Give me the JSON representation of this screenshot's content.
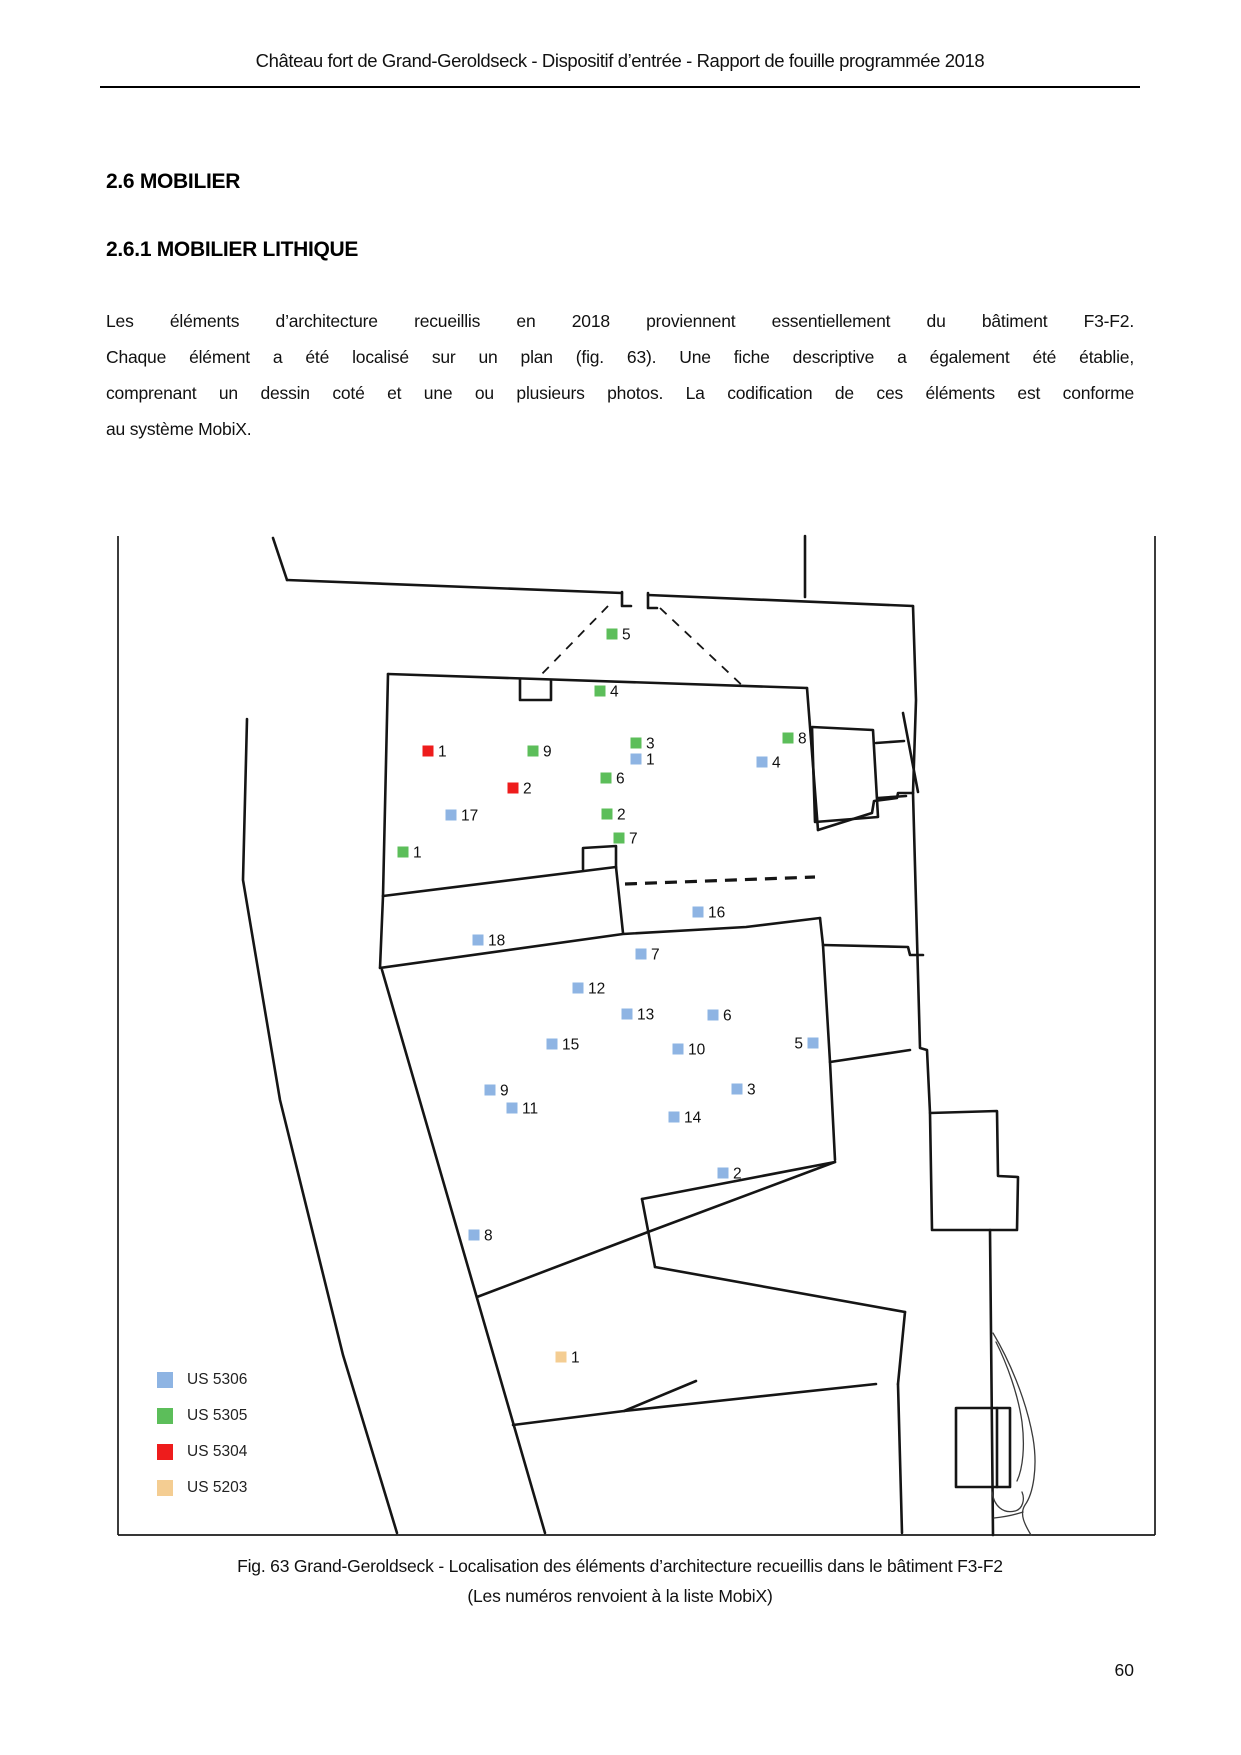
{
  "header": {
    "title": "Château fort de Grand-Geroldseck - Dispositif d’entrée - Rapport de fouille programmée 2018"
  },
  "sections": {
    "h1": "2.6 MOBILIER",
    "h2": "2.6.1 MOBILIER LITHIQUE"
  },
  "paragraph": {
    "lines": [
      "Les éléments d’architecture recueillis en 2018 proviennent essentiellement du bâtiment F3-F2.",
      "Chaque élément a été localisé sur un plan (fig. 63). Une fiche descriptive a également été établie,",
      "comprenant un dessin coté et une ou plusieurs photos. La codification de ces éléments est conforme",
      "au système MobiX."
    ]
  },
  "figure": {
    "caption_line1": "Fig. 63 Grand-Geroldseck - Localisation des éléments d’architecture recueillis dans le bâtiment F3-F2",
    "caption_line2": "(Les numéros renvoient à la liste MobiX)",
    "colors": {
      "US5306": "#8eb4e3",
      "US5305": "#5cbe5a",
      "US5304": "#ee1c1c",
      "US5203": "#f4cd92"
    },
    "legend": [
      {
        "label": "US 5306",
        "us": "US5306"
      },
      {
        "label": "US 5305",
        "us": "US5305"
      },
      {
        "label": "US 5304",
        "us": "US5304"
      },
      {
        "label": "US 5203",
        "us": "US5203"
      }
    ],
    "markers": [
      {
        "n": "5",
        "us": "US5305",
        "x": 612,
        "y": 634,
        "side": "right"
      },
      {
        "n": "4",
        "us": "US5305",
        "x": 600,
        "y": 691,
        "side": "right"
      },
      {
        "n": "9",
        "us": "US5305",
        "x": 533,
        "y": 751,
        "side": "right"
      },
      {
        "n": "3",
        "us": "US5305",
        "x": 636,
        "y": 743,
        "side": "right"
      },
      {
        "n": "8",
        "us": "US5305",
        "x": 788,
        "y": 738,
        "side": "right"
      },
      {
        "n": "6",
        "us": "US5305",
        "x": 606,
        "y": 778,
        "side": "right"
      },
      {
        "n": "2",
        "us": "US5305",
        "x": 607,
        "y": 814,
        "side": "right"
      },
      {
        "n": "7",
        "us": "US5305",
        "x": 619,
        "y": 838,
        "side": "right"
      },
      {
        "n": "1",
        "us": "US5305",
        "x": 403,
        "y": 852,
        "side": "right"
      },
      {
        "n": "1",
        "us": "US5304",
        "x": 428,
        "y": 751,
        "side": "right"
      },
      {
        "n": "2",
        "us": "US5304",
        "x": 513,
        "y": 788,
        "side": "right"
      },
      {
        "n": "1",
        "us": "US5306",
        "x": 636,
        "y": 759,
        "side": "right"
      },
      {
        "n": "4",
        "us": "US5306",
        "x": 762,
        "y": 762,
        "side": "right"
      },
      {
        "n": "17",
        "us": "US5306",
        "x": 451,
        "y": 815,
        "side": "right"
      },
      {
        "n": "16",
        "us": "US5306",
        "x": 698,
        "y": 912,
        "side": "right"
      },
      {
        "n": "18",
        "us": "US5306",
        "x": 478,
        "y": 940,
        "side": "right"
      },
      {
        "n": "7",
        "us": "US5306",
        "x": 641,
        "y": 954,
        "side": "right"
      },
      {
        "n": "12",
        "us": "US5306",
        "x": 578,
        "y": 988,
        "side": "right"
      },
      {
        "n": "13",
        "us": "US5306",
        "x": 627,
        "y": 1014,
        "side": "right"
      },
      {
        "n": "6",
        "us": "US5306",
        "x": 713,
        "y": 1015,
        "side": "right"
      },
      {
        "n": "15",
        "us": "US5306",
        "x": 552,
        "y": 1044,
        "side": "right"
      },
      {
        "n": "10",
        "us": "US5306",
        "x": 678,
        "y": 1049,
        "side": "right"
      },
      {
        "n": "5",
        "us": "US5306",
        "x": 813,
        "y": 1043,
        "side": "left"
      },
      {
        "n": "9",
        "us": "US5306",
        "x": 490,
        "y": 1090,
        "side": "right"
      },
      {
        "n": "3",
        "us": "US5306",
        "x": 737,
        "y": 1089,
        "side": "right"
      },
      {
        "n": "11",
        "us": "US5306",
        "x": 512,
        "y": 1108,
        "side": "right"
      },
      {
        "n": "14",
        "us": "US5306",
        "x": 674,
        "y": 1117,
        "side": "right"
      },
      {
        "n": "2",
        "us": "US5306",
        "x": 723,
        "y": 1173,
        "side": "right"
      },
      {
        "n": "8",
        "us": "US5306",
        "x": 474,
        "y": 1235,
        "side": "right"
      },
      {
        "n": "1",
        "us": "US5203",
        "x": 561,
        "y": 1357,
        "side": "right"
      }
    ]
  },
  "page": {
    "number": "60"
  }
}
